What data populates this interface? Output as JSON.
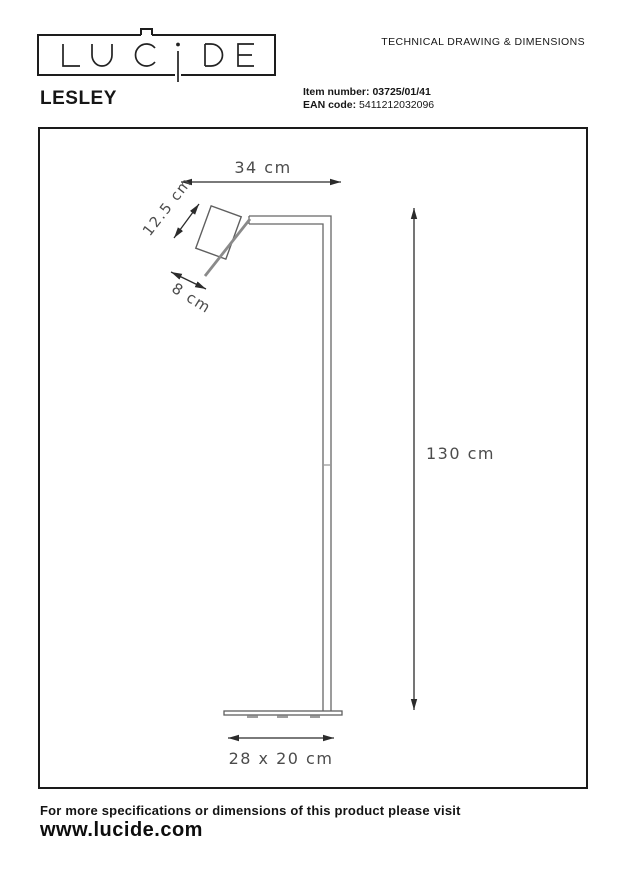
{
  "header": {
    "logo_text": "LUCIDE",
    "doc_title": "TECHNICAL DRAWING & DIMENSIONS",
    "product_name": "LESLEY",
    "item_number_label": "Item number:",
    "item_number_value": "03725/01/41",
    "ean_label": "EAN code:",
    "ean_value": "5411212032096"
  },
  "drawing": {
    "type": "technical-line-drawing",
    "subject": "floor lamp side view",
    "dimensions": {
      "arm_width": "34 cm",
      "shade_length": "12.5 cm",
      "shade_diameter": "8 cm",
      "height": "130 cm",
      "base": "28 x 20 cm"
    }
  },
  "footer": {
    "note": "For more specifications or dimensions of this product please visit",
    "website": "www.lucide.com"
  },
  "colors": {
    "ink": "#161616",
    "dimension_line": "#2b2b2b",
    "lamp_outline": "#666666",
    "shade_rim": "#8a8a8a",
    "dim_text": "#4c4c4c"
  }
}
